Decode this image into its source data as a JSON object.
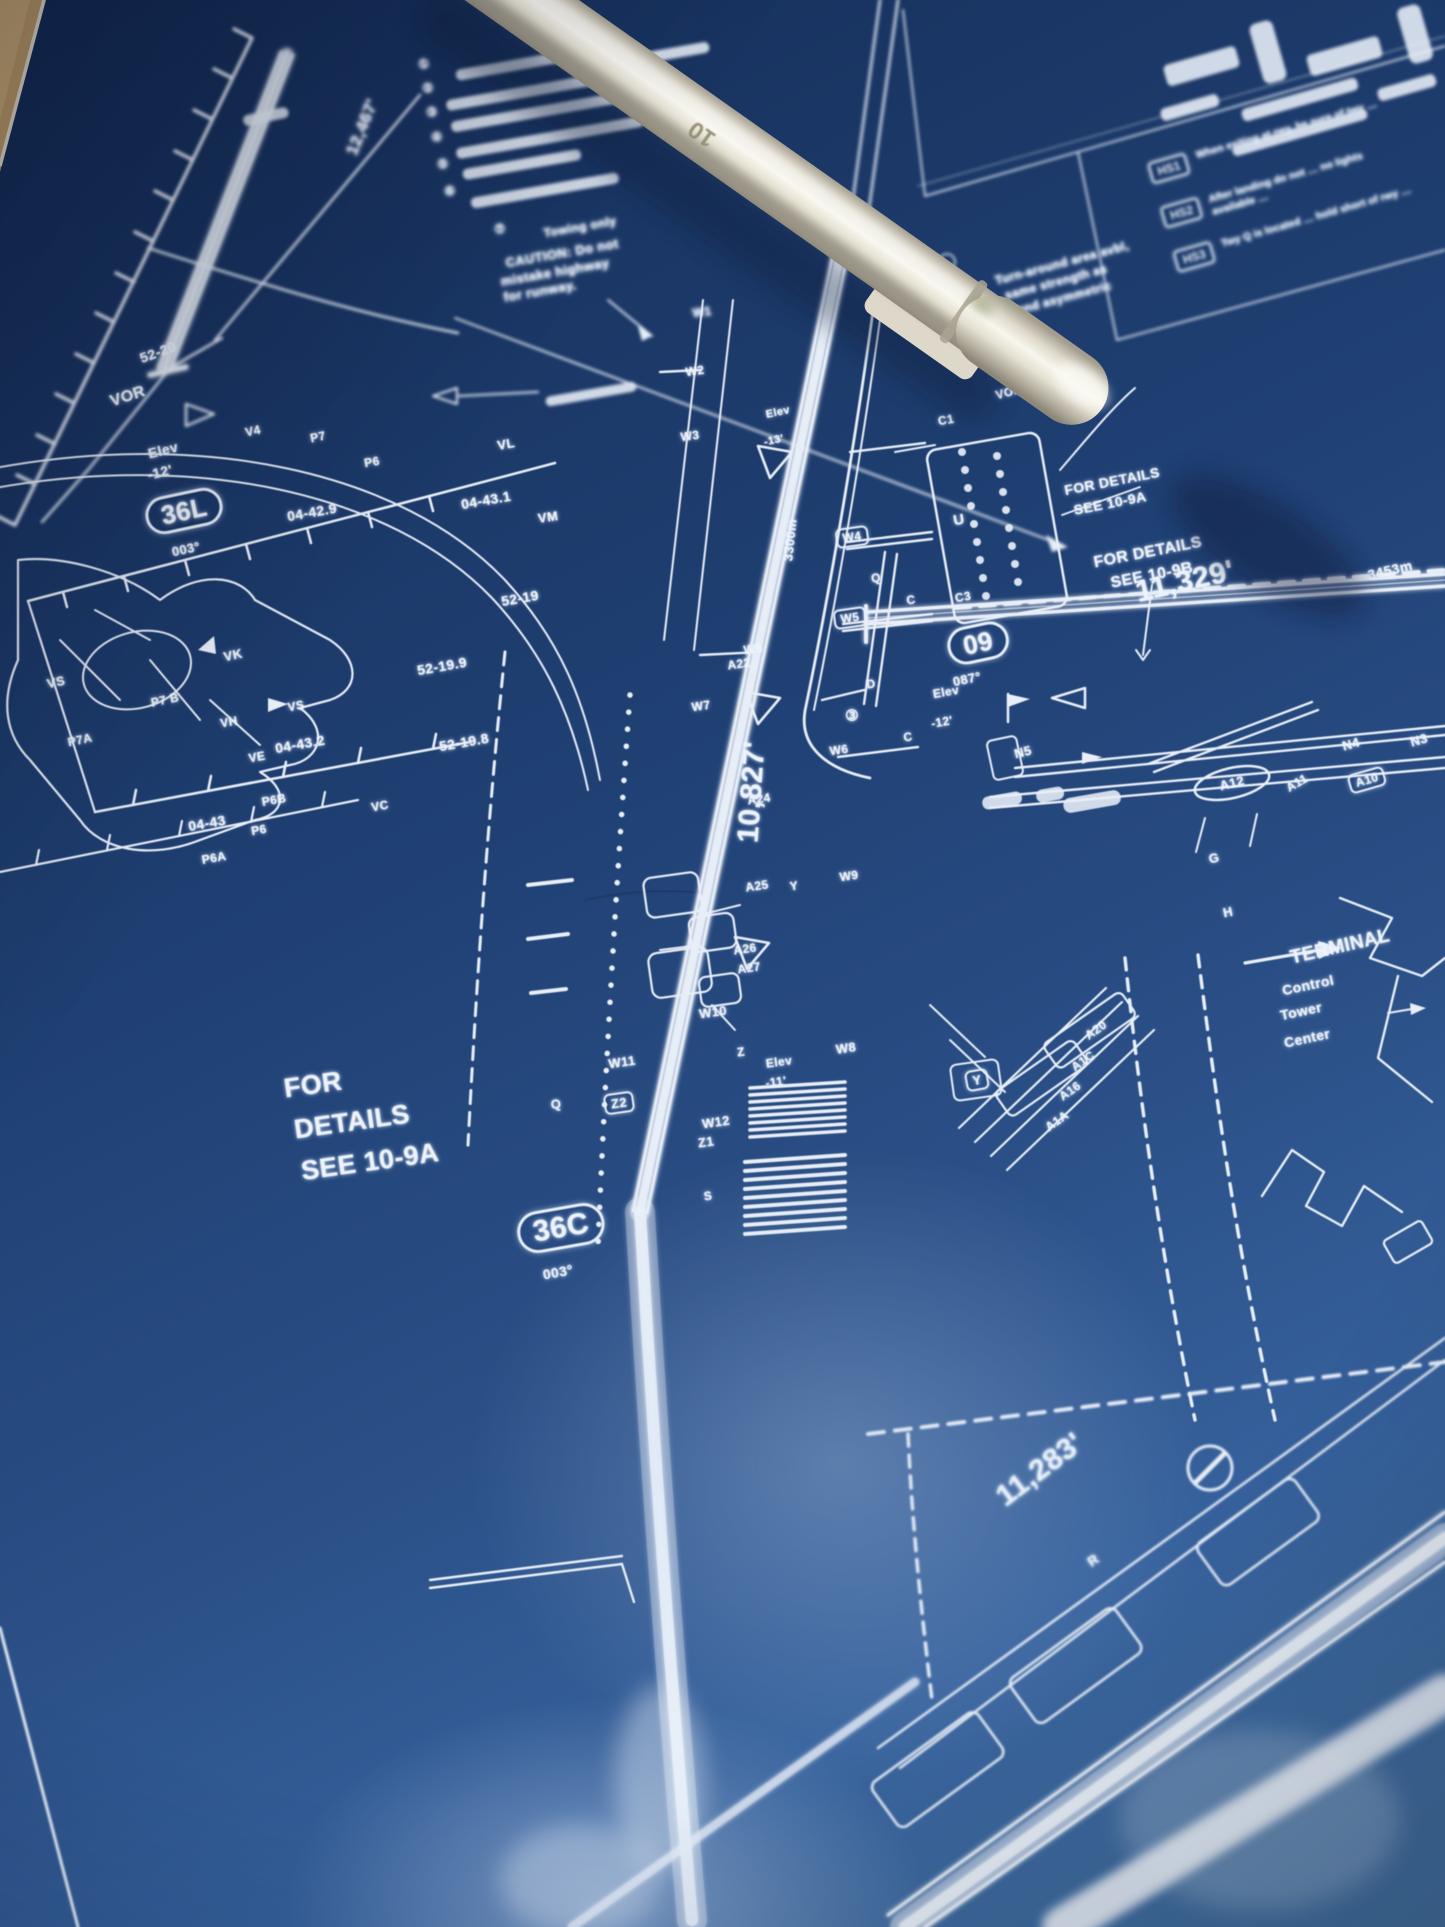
{
  "photo": {
    "pen_size_label": "10"
  },
  "hotspots": {
    "rows": [
      {
        "tag": "HS1",
        "text": "When exiting at rwy, be sure of twy …"
      },
      {
        "tag": "HS2",
        "text": "After landing do not … no lights available …"
      },
      {
        "tag": "HS3",
        "text": "Twy Q is located … hold short of rwy …"
      }
    ]
  },
  "map_labels": [
    {
      "id": "coord-52-20",
      "t": "52-20",
      "x": 158,
      "y": 352,
      "r": -20,
      "s": 14
    },
    {
      "id": "vor-left-label",
      "t": "VOR",
      "x": 128,
      "y": 397,
      "r": -18,
      "s": 16
    },
    {
      "id": "elev-36l-word",
      "t": "Elev",
      "x": 163,
      "y": 450,
      "r": -14,
      "s": 14
    },
    {
      "id": "elev-36l-value",
      "t": "-12'",
      "x": 160,
      "y": 472,
      "r": -14,
      "s": 14
    },
    {
      "id": "rwy-36l-length",
      "t": "12,467'",
      "x": 362,
      "y": 127,
      "r": -68,
      "s": 17
    },
    {
      "id": "rwy-36l-designator",
      "t": "36L",
      "x": 184,
      "y": 511,
      "r": -12,
      "s": 26,
      "b": "oval"
    },
    {
      "id": "rwy-36l-bearing",
      "t": "003°",
      "x": 186,
      "y": 549,
      "r": -12,
      "s": 13
    },
    {
      "id": "twy-v4",
      "t": "V4",
      "x": 253,
      "y": 431,
      "r": -12,
      "s": 12
    },
    {
      "id": "twy-p7-top",
      "t": "P7",
      "x": 318,
      "y": 437,
      "r": -12,
      "s": 12
    },
    {
      "id": "twy-p6-top",
      "t": "P6",
      "x": 372,
      "y": 462,
      "r": -10,
      "s": 12
    },
    {
      "id": "twy-vl",
      "t": "VL",
      "x": 506,
      "y": 444,
      "r": -10,
      "s": 13
    },
    {
      "id": "twy-vm",
      "t": "VM",
      "x": 548,
      "y": 517,
      "r": -8,
      "s": 13
    },
    {
      "id": "coord-04-42-9",
      "t": "04-42.9",
      "x": 312,
      "y": 512,
      "r": -10,
      "s": 14
    },
    {
      "id": "coord-04-43-1",
      "t": "04-43.1",
      "x": 486,
      "y": 500,
      "r": -10,
      "s": 14
    },
    {
      "id": "coord-52-19-9",
      "t": "52-19.9",
      "x": 442,
      "y": 666,
      "r": -10,
      "s": 14
    },
    {
      "id": "coord-52-19-8",
      "t": "52-19.8",
      "x": 464,
      "y": 742,
      "r": -10,
      "s": 14
    },
    {
      "id": "coord-52-19",
      "t": "52-19",
      "x": 520,
      "y": 598,
      "r": -10,
      "s": 14
    },
    {
      "id": "twy-vk",
      "t": "VK",
      "x": 233,
      "y": 655,
      "r": -12,
      "s": 13
    },
    {
      "id": "twy-vs-west",
      "t": "VS",
      "x": 56,
      "y": 682,
      "r": -12,
      "s": 13
    },
    {
      "id": "twy-p7b",
      "t": "P7 B",
      "x": 165,
      "y": 700,
      "r": -12,
      "s": 12
    },
    {
      "id": "twy-p7a",
      "t": "P7A",
      "x": 80,
      "y": 740,
      "r": -12,
      "s": 12
    },
    {
      "id": "twy-vh",
      "t": "VH",
      "x": 229,
      "y": 722,
      "r": -10,
      "s": 12
    },
    {
      "id": "twy-ve",
      "t": "VE",
      "x": 257,
      "y": 757,
      "r": -10,
      "s": 12
    },
    {
      "id": "twy-vs-east",
      "t": "VS",
      "x": 296,
      "y": 706,
      "r": -10,
      "s": 12
    },
    {
      "id": "twy-p6b",
      "t": "P6B",
      "x": 274,
      "y": 800,
      "r": -10,
      "s": 12
    },
    {
      "id": "twy-p6-mid",
      "t": "P6",
      "x": 259,
      "y": 830,
      "r": -10,
      "s": 12
    },
    {
      "id": "twy-p6a",
      "t": "P6A",
      "x": 214,
      "y": 858,
      "r": -10,
      "s": 12
    },
    {
      "id": "twy-vc",
      "t": "VC",
      "x": 380,
      "y": 806,
      "r": -10,
      "s": 12
    },
    {
      "id": "coord-04-43-2",
      "t": "04-43.2",
      "x": 300,
      "y": 744,
      "r": -10,
      "s": 14
    },
    {
      "id": "coord-04-43",
      "t": "04-43",
      "x": 207,
      "y": 823,
      "r": -10,
      "s": 14
    },
    {
      "id": "rwy-36c-length-m",
      "t": "3300m",
      "x": 790,
      "y": 540,
      "r": -84,
      "s": 13
    },
    {
      "id": "rwy-36c-length-ft",
      "t": "10,827'",
      "x": 752,
      "y": 792,
      "r": -86,
      "s": 30
    },
    {
      "id": "twy-w1",
      "t": "W1",
      "x": 702,
      "y": 312,
      "r": -8,
      "s": 12
    },
    {
      "id": "twy-w2",
      "t": "W2",
      "x": 695,
      "y": 371,
      "r": -8,
      "s": 12
    },
    {
      "id": "twy-w3",
      "t": "W3",
      "x": 690,
      "y": 436,
      "r": -8,
      "s": 12
    },
    {
      "id": "twy-w4",
      "t": "W4",
      "x": 852,
      "y": 537,
      "r": -8,
      "s": 12,
      "b": "box"
    },
    {
      "id": "twy-w5",
      "t": "W5",
      "x": 850,
      "y": 618,
      "r": -8,
      "s": 12,
      "b": "box"
    },
    {
      "id": "twy-w5-west",
      "t": "W5",
      "x": 753,
      "y": 649,
      "r": -8,
      "s": 12
    },
    {
      "id": "twy-w6",
      "t": "W6",
      "x": 839,
      "y": 750,
      "r": -8,
      "s": 12
    },
    {
      "id": "twy-w7",
      "t": "W7",
      "x": 701,
      "y": 706,
      "r": -8,
      "s": 12
    },
    {
      "id": "twy-w8",
      "t": "W8",
      "x": 846,
      "y": 1048,
      "r": -8,
      "s": 13
    },
    {
      "id": "twy-w9",
      "t": "W9",
      "x": 849,
      "y": 876,
      "r": -8,
      "s": 12
    },
    {
      "id": "twy-w10",
      "t": "W10",
      "x": 713,
      "y": 1012,
      "r": -8,
      "s": 13
    },
    {
      "id": "twy-w11",
      "t": "W11",
      "x": 622,
      "y": 1062,
      "r": -8,
      "s": 13
    },
    {
      "id": "twy-w12",
      "t": "W12",
      "x": 716,
      "y": 1122,
      "r": -8,
      "s": 13
    },
    {
      "id": "twy-z2",
      "t": "Z2",
      "x": 619,
      "y": 1103,
      "r": -8,
      "s": 13,
      "b": "box"
    },
    {
      "id": "twy-z1",
      "t": "Z1",
      "x": 706,
      "y": 1142,
      "r": -8,
      "s": 13
    },
    {
      "id": "twy-z",
      "t": "Z",
      "x": 741,
      "y": 1052,
      "r": -8,
      "s": 12
    },
    {
      "id": "twy-q-south",
      "t": "Q",
      "x": 556,
      "y": 1104,
      "r": -8,
      "s": 13
    },
    {
      "id": "twy-s",
      "t": "S",
      "x": 708,
      "y": 1196,
      "r": -8,
      "s": 12
    },
    {
      "id": "elev-36c-word",
      "t": "Elev",
      "x": 779,
      "y": 1062,
      "r": -8,
      "s": 12
    },
    {
      "id": "elev-36c-value",
      "t": "-11'",
      "x": 776,
      "y": 1082,
      "r": -8,
      "s": 12
    },
    {
      "id": "twy-a22",
      "t": "A22",
      "x": 739,
      "y": 664,
      "r": -8,
      "s": 12
    },
    {
      "id": "twy-a24",
      "t": "A24",
      "x": 759,
      "y": 799,
      "r": -8,
      "s": 12
    },
    {
      "id": "twy-a25",
      "t": "A25",
      "x": 757,
      "y": 886,
      "r": -8,
      "s": 12
    },
    {
      "id": "twy-y-mid",
      "t": "Y",
      "x": 794,
      "y": 886,
      "r": -8,
      "s": 12
    },
    {
      "id": "twy-a26",
      "t": "A26",
      "x": 745,
      "y": 949,
      "r": -8,
      "s": 12
    },
    {
      "id": "twy-a27",
      "t": "A27",
      "x": 749,
      "y": 968,
      "r": -8,
      "s": 12
    },
    {
      "id": "note-circled-3",
      "t": "③",
      "x": 852,
      "y": 716,
      "r": 0,
      "s": 15
    },
    {
      "id": "twy-d",
      "t": "D",
      "x": 871,
      "y": 684,
      "r": -8,
      "s": 12
    },
    {
      "id": "twy-c-mid",
      "t": "C",
      "x": 908,
      "y": 737,
      "r": -8,
      "s": 12
    },
    {
      "id": "twy-q-north",
      "t": "Q",
      "x": 876,
      "y": 578,
      "r": -8,
      "s": 12
    },
    {
      "id": "twy-c-north",
      "t": "C",
      "x": 911,
      "y": 600,
      "r": -8,
      "s": 12
    },
    {
      "id": "twy-c1",
      "t": "C1",
      "x": 946,
      "y": 420,
      "r": -10,
      "s": 12
    },
    {
      "id": "twy-c3",
      "t": "C3",
      "x": 963,
      "y": 597,
      "r": -10,
      "s": 12
    },
    {
      "id": "apron-u",
      "t": "U",
      "x": 959,
      "y": 520,
      "r": -10,
      "s": 15
    },
    {
      "id": "rwy-09-designator",
      "t": "09",
      "x": 978,
      "y": 643,
      "r": -12,
      "s": 26,
      "b": "oval"
    },
    {
      "id": "rwy-09-bearing",
      "t": "087°",
      "x": 967,
      "y": 679,
      "r": -12,
      "s": 13
    },
    {
      "id": "elev-09-word",
      "t": "Elev",
      "x": 946,
      "y": 692,
      "r": -10,
      "s": 12
    },
    {
      "id": "elev-09-value",
      "t": "-12'",
      "x": 942,
      "y": 722,
      "r": -10,
      "s": 12
    },
    {
      "id": "rwy-09-length-ft",
      "t": "11,329'",
      "x": 1185,
      "y": 582,
      "r": -13,
      "s": 30
    },
    {
      "id": "rwy-09-length-m",
      "t": "3453m",
      "x": 1390,
      "y": 570,
      "r": -13,
      "s": 14
    },
    {
      "id": "twy-n5",
      "t": "N5",
      "x": 1023,
      "y": 752,
      "r": -14,
      "s": 13
    },
    {
      "id": "twy-n4",
      "t": "N4",
      "x": 1351,
      "y": 744,
      "r": -16,
      "s": 13
    },
    {
      "id": "twy-n3",
      "t": "N3",
      "x": 1419,
      "y": 740,
      "r": -16,
      "s": 13
    },
    {
      "id": "twy-a12",
      "t": "A12",
      "x": 1232,
      "y": 783,
      "r": -14,
      "s": 13
    },
    {
      "id": "twy-a11",
      "t": "A11",
      "x": 1297,
      "y": 783,
      "r": -30,
      "s": 12
    },
    {
      "id": "twy-a10",
      "t": "A10",
      "x": 1367,
      "y": 780,
      "r": -16,
      "s": 12,
      "b": "box"
    },
    {
      "id": "twy-g",
      "t": "G",
      "x": 1214,
      "y": 858,
      "r": -12,
      "s": 13
    },
    {
      "id": "twy-h",
      "t": "H",
      "x": 1228,
      "y": 912,
      "r": -12,
      "s": 13
    },
    {
      "id": "terminal-label",
      "t": "TERMINAL",
      "x": 1340,
      "y": 947,
      "r": -13,
      "s": 19
    },
    {
      "id": "control-tower-1",
      "t": "Control",
      "x": 1308,
      "y": 985,
      "r": -12,
      "s": 14
    },
    {
      "id": "control-tower-2",
      "t": "Tower",
      "x": 1301,
      "y": 1011,
      "r": -12,
      "s": 14
    },
    {
      "id": "control-tower-3",
      "t": "Center",
      "x": 1307,
      "y": 1038,
      "r": -12,
      "s": 14
    },
    {
      "id": "twy-y-box",
      "t": "Y",
      "x": 977,
      "y": 1080,
      "r": -10,
      "s": 13,
      "b": "box"
    },
    {
      "id": "details-left-1",
      "t": "FOR",
      "x": 313,
      "y": 1085,
      "r": -8,
      "s": 27
    },
    {
      "id": "details-left-2",
      "t": "DETAILS",
      "x": 352,
      "y": 1122,
      "r": -8,
      "s": 27
    },
    {
      "id": "details-left-3",
      "t": "SEE 10-9A",
      "x": 370,
      "y": 1162,
      "r": -8,
      "s": 27
    },
    {
      "id": "details-a-1",
      "t": "FOR DETAILS",
      "x": 1112,
      "y": 481,
      "r": -11,
      "s": 14
    },
    {
      "id": "details-a-2",
      "t": "SEE 10-9A",
      "x": 1110,
      "y": 503,
      "r": -11,
      "s": 14
    },
    {
      "id": "details-b-1",
      "t": "FOR DETAILS",
      "x": 1148,
      "y": 553,
      "r": -11,
      "s": 16
    },
    {
      "id": "details-b-2",
      "t": "SEE 10-9B",
      "x": 1152,
      "y": 576,
      "r": -11,
      "s": 16
    },
    {
      "id": "rwy-36c-designator",
      "t": "36C",
      "x": 561,
      "y": 1228,
      "r": -10,
      "s": 30,
      "b": "oval"
    },
    {
      "id": "rwy-36c-bearing",
      "t": "003°",
      "x": 558,
      "y": 1272,
      "r": -10,
      "s": 14
    },
    {
      "id": "rwy-06-length-ft",
      "t": "11,283'",
      "x": 1040,
      "y": 1470,
      "r": -37,
      "s": 30
    },
    {
      "id": "twy-r",
      "t": "R",
      "x": 1093,
      "y": 1560,
      "r": -35,
      "s": 14
    },
    {
      "id": "twy-a20",
      "t": "A20",
      "x": 1096,
      "y": 1030,
      "r": -35,
      "s": 12
    },
    {
      "id": "twy-a1c",
      "t": "A1C",
      "x": 1083,
      "y": 1061,
      "r": -35,
      "s": 12
    },
    {
      "id": "twy-a16",
      "t": "A16",
      "x": 1070,
      "y": 1091,
      "r": -35,
      "s": 12
    },
    {
      "id": "twy-a1a",
      "t": "A1A",
      "x": 1057,
      "y": 1121,
      "r": -35,
      "s": 12
    },
    {
      "id": "vor-right-label",
      "t": "VOR",
      "x": 1009,
      "y": 392,
      "r": -15,
      "s": 12
    },
    {
      "id": "elev-18c-word",
      "t": "Elev",
      "x": 778,
      "y": 413,
      "r": -12,
      "s": 11
    },
    {
      "id": "elev-18c-value",
      "t": "-13'",
      "x": 774,
      "y": 441,
      "r": -12,
      "s": 11
    },
    {
      "id": "caution-line-1",
      "t": "CAUTION: Do not",
      "x": 562,
      "y": 253,
      "r": -10,
      "s": 13
    },
    {
      "id": "caution-line-2",
      "t": "mistake highway",
      "x": 555,
      "y": 272,
      "r": -10,
      "s": 13
    },
    {
      "id": "caution-line-3",
      "t": "for runway.",
      "x": 540,
      "y": 291,
      "r": -10,
      "s": 13
    },
    {
      "id": "note-circled-7",
      "t": "⑦",
      "x": 500,
      "y": 229,
      "r": -10,
      "s": 12
    },
    {
      "id": "note-towing",
      "t": "Towing only",
      "x": 580,
      "y": 227,
      "r": -10,
      "s": 12
    },
    {
      "id": "turnaround-line-1",
      "t": "Turn-around area avbl,",
      "x": 1062,
      "y": 263,
      "r": -15,
      "s": 12
    },
    {
      "id": "turnaround-line-2",
      "t": "same strength as",
      "x": 1056,
      "y": 282,
      "r": -15,
      "s": 12
    },
    {
      "id": "turnaround-line-3",
      "t": "rwy and asymmetric",
      "x": 1052,
      "y": 301,
      "r": -15,
      "s": 12
    },
    {
      "id": "note-circled-1",
      "t": "①",
      "x": 424,
      "y": 64,
      "r": -10,
      "s": 12
    },
    {
      "id": "note-circled-2",
      "t": "②",
      "x": 428,
      "y": 88,
      "r": -10,
      "s": 12
    },
    {
      "id": "note-circled-3b",
      "t": "③",
      "x": 432,
      "y": 112,
      "r": -10,
      "s": 12
    },
    {
      "id": "note-circled-4",
      "t": "④",
      "x": 437,
      "y": 137,
      "r": -10,
      "s": 12
    },
    {
      "id": "note-circled-5",
      "t": "⑤",
      "x": 443,
      "y": 164,
      "r": -10,
      "s": 12
    },
    {
      "id": "note-circled-6",
      "t": "⑥",
      "x": 450,
      "y": 191,
      "r": -10,
      "s": 12
    }
  ]
}
